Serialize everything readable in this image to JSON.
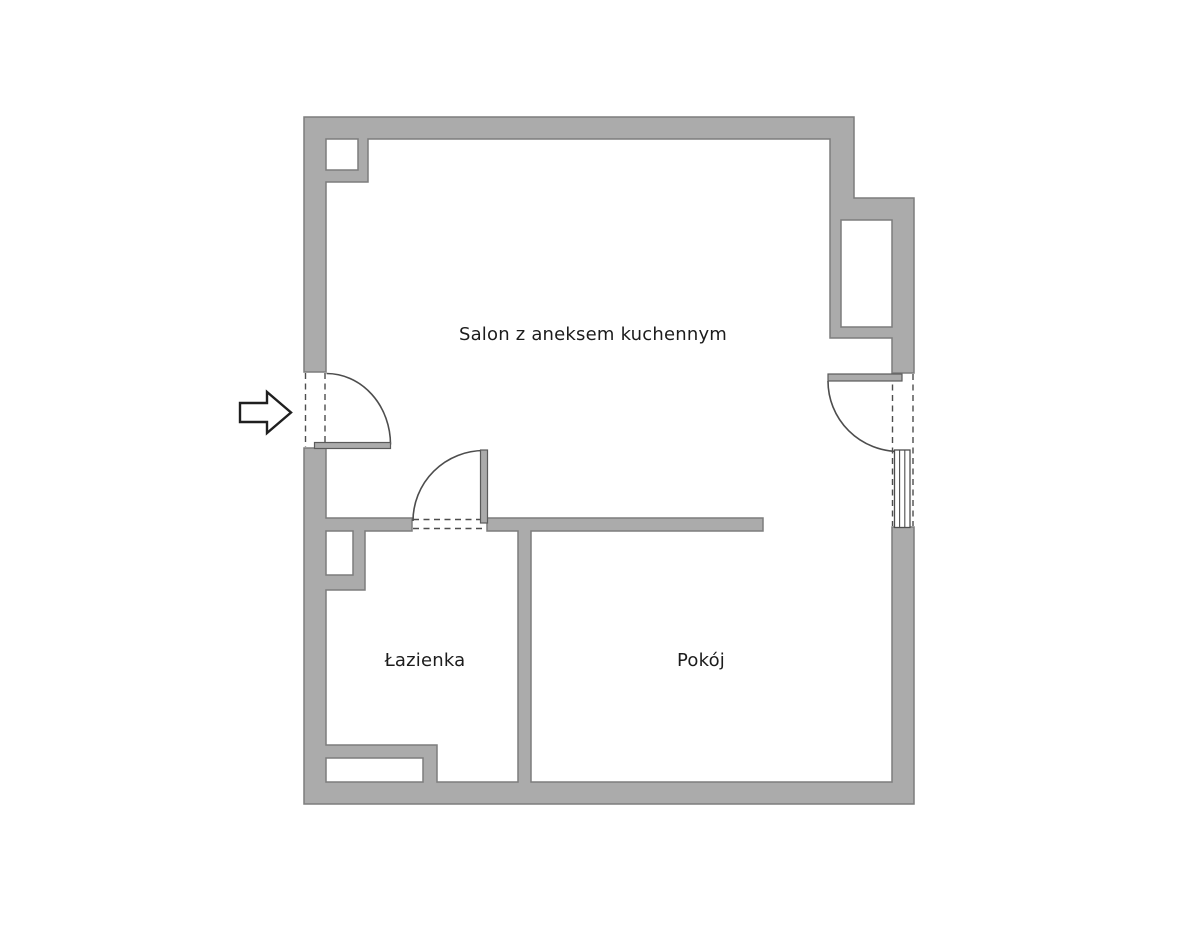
{
  "floorplan": {
    "background_color": "#ffffff",
    "wall_fill_color": "#ababab",
    "wall_outline_color": "#7d7d7d",
    "detail_line_color": "#4d4d4d",
    "label_color": "#1c1c1c",
    "rooms": [
      {
        "label": "Salon z aneksem kuchennym"
      },
      {
        "label": "Łazienka"
      },
      {
        "label": "Pokój"
      }
    ],
    "entrance": {
      "icon": "entrance-arrow-icon",
      "direction": "right"
    }
  }
}
